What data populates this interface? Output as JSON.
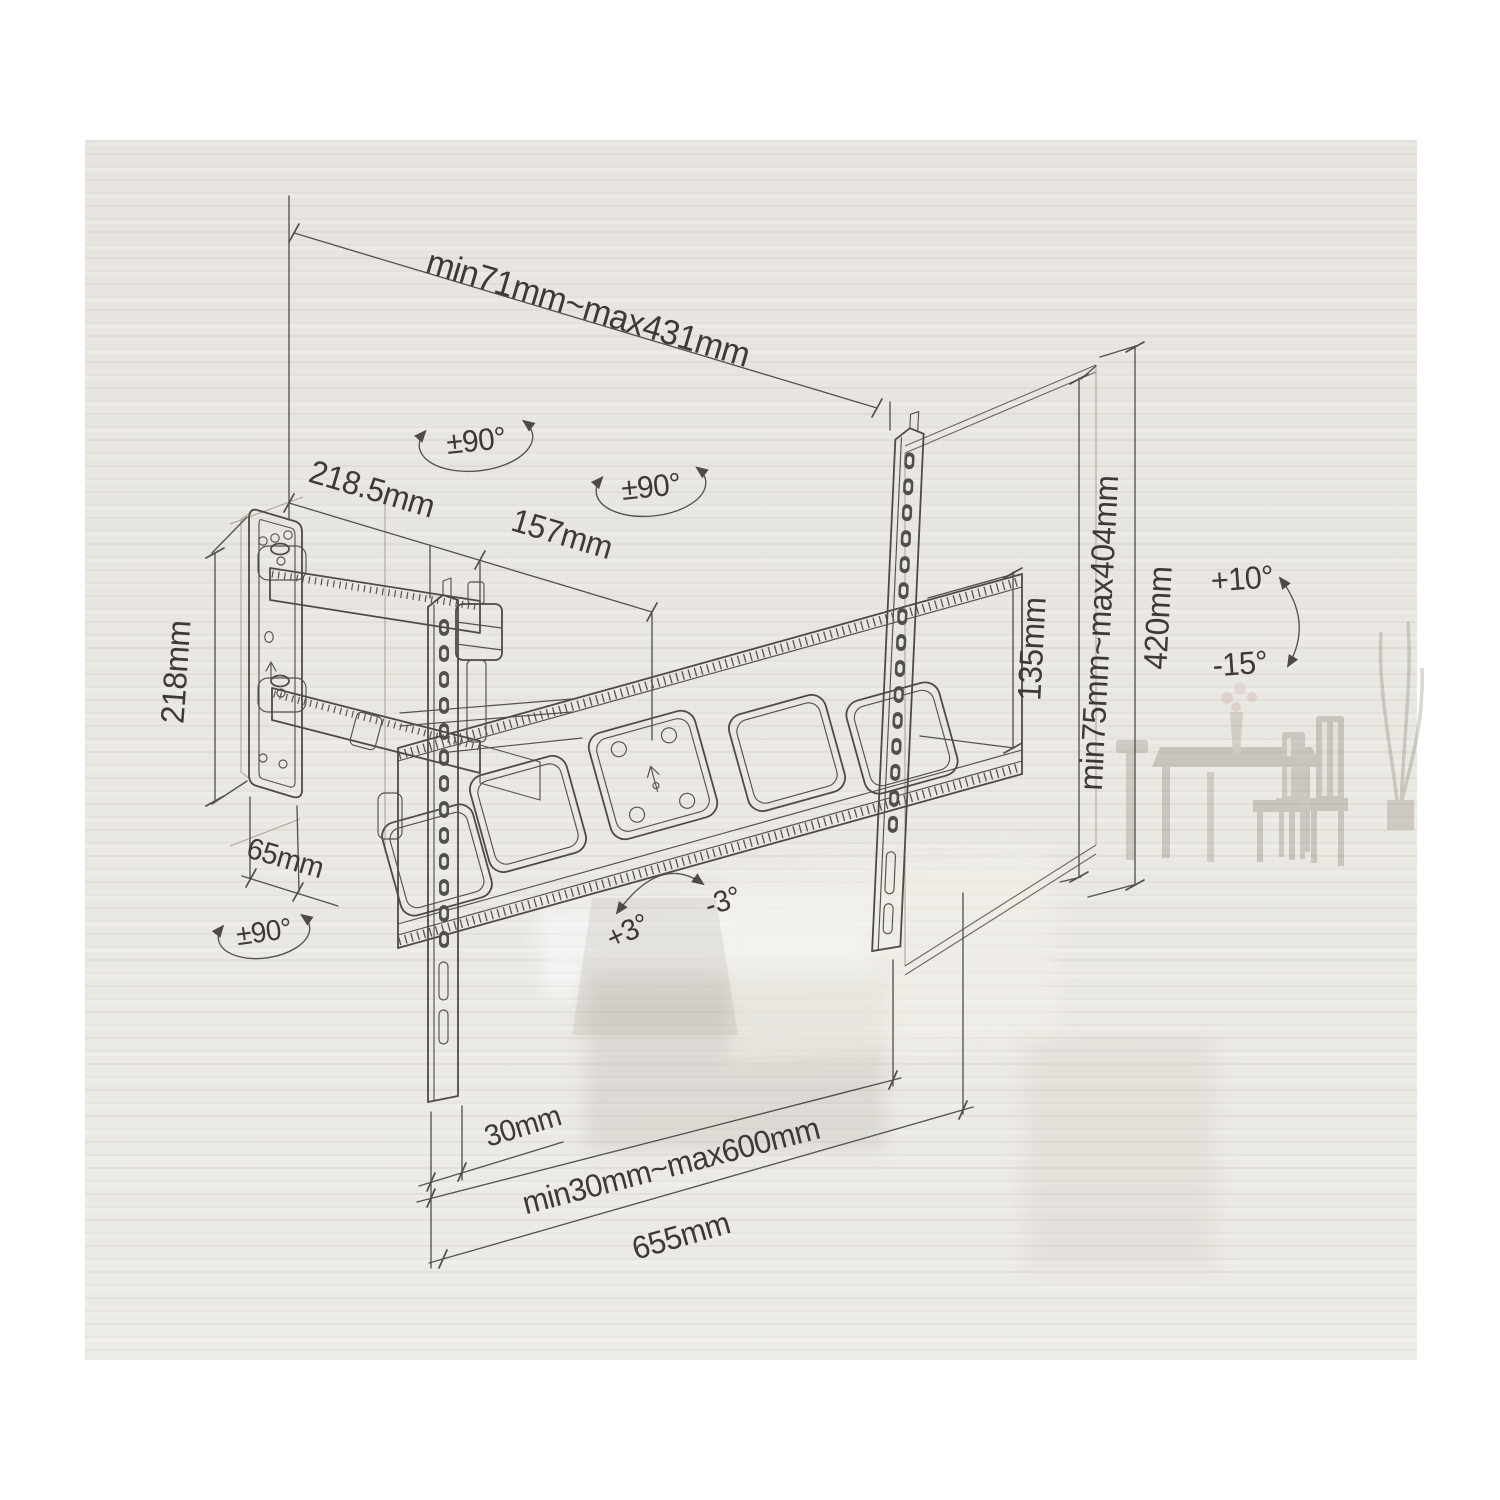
{
  "figure": {
    "kind": "technical dimension diagram",
    "subject": "articulating full-motion TV wall mount, isometric line drawing on product box",
    "labels": {
      "extension_range": "min71mm~max431mm",
      "swivel_upper": "±90°",
      "swivel_front": "±90°",
      "swivel_wall": "±90°",
      "arm_rear_length": "218.5mm",
      "arm_front_length": "157mm",
      "wall_plate_height": "218mm",
      "wall_plate_width": "65mm",
      "rail_slot_span": "135mm",
      "vesa_vertical_range": "min75mm~max404mm",
      "rail_height": "420mm",
      "tilt_up": "+10°",
      "tilt_down": "-15°",
      "level_cw": "+3°",
      "level_ccw": "-3°",
      "rail_width": "30mm",
      "vesa_horizontal_range": "min30mm~max600mm",
      "crossbar_length": "655mm"
    }
  }
}
